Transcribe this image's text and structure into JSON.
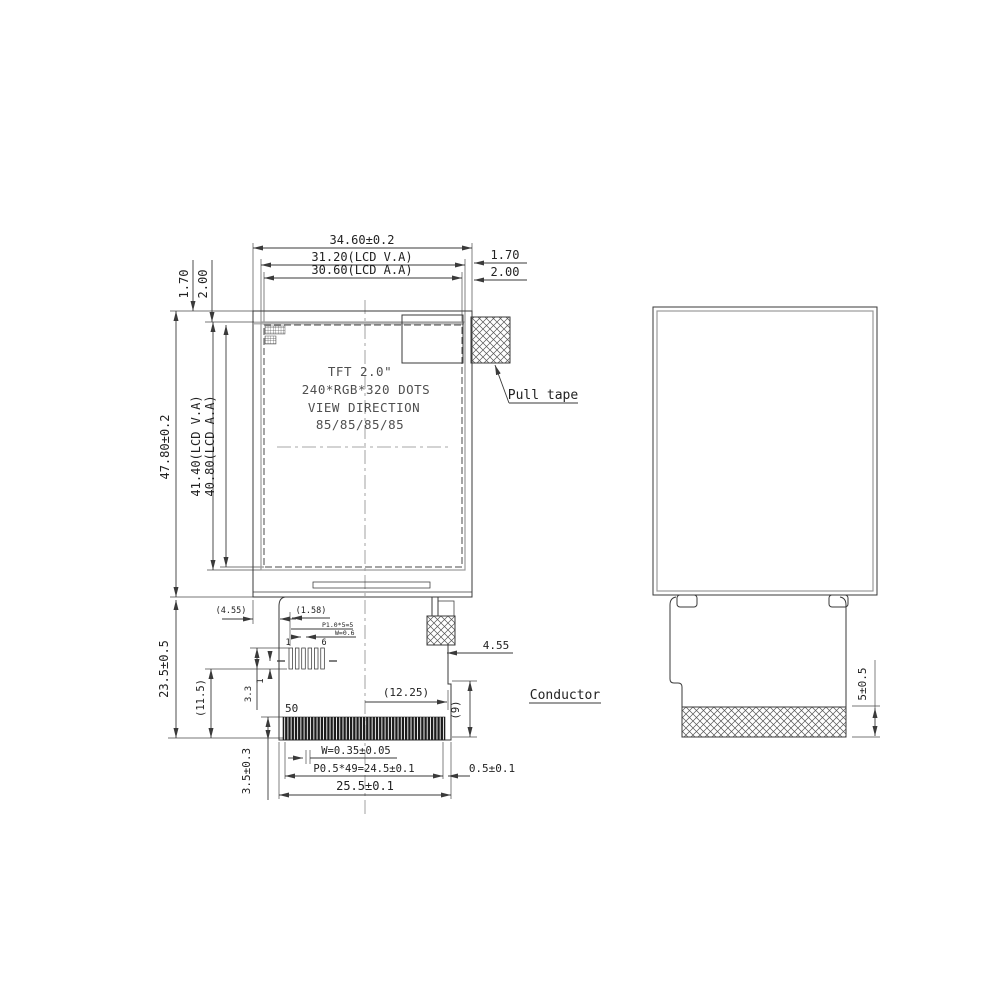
{
  "front_view": {
    "top_dims": {
      "outline": "34.60±0.2",
      "va": "31.20(LCD V.A)",
      "aa": "30.60(LCD A.A)",
      "right_gap1": "1.70",
      "right_gap2": "2.00",
      "left_gap1": "1.70",
      "left_gap2": "2.00"
    },
    "left_dims": {
      "outline": "47.80±0.2",
      "va": "41.40(LCD V.A)",
      "aa": "40.80(LCD A.A)"
    },
    "panel_text": {
      "line1": "TFT 2.0\"",
      "line2": "240*RGB*320 DOTS",
      "line3": "VIEW DIRECTION",
      "line4": "85/85/85/85"
    },
    "pull_tape_label": "Pull tape",
    "fpc_dims": {
      "length": "23.5±0.5",
      "inner_length": "(11.5)",
      "left_offset": "(4.55)",
      "pin_offset": "(1.58)",
      "pin_pitch": "P1.0*5=5",
      "pin_width": "W=0.6",
      "pin_first": "1",
      "pin_last": "6",
      "pin_height": "3.3",
      "pin_gap": "1",
      "conductor_count": "50",
      "center_offset": "(12.25)",
      "right_offset": "(9)",
      "tape_offset": "4.55",
      "conductor_width": "W=0.35±0.05",
      "conductor_pitch": "P0.5*49=24.5±0.1",
      "edge_margin": "0.5±0.1",
      "fpc_width": "25.5±0.1",
      "conductor_length": "3.5±0.3"
    },
    "conductor_label": "Conductor"
  },
  "side_view": {
    "conductor_height": "5±0.5"
  }
}
